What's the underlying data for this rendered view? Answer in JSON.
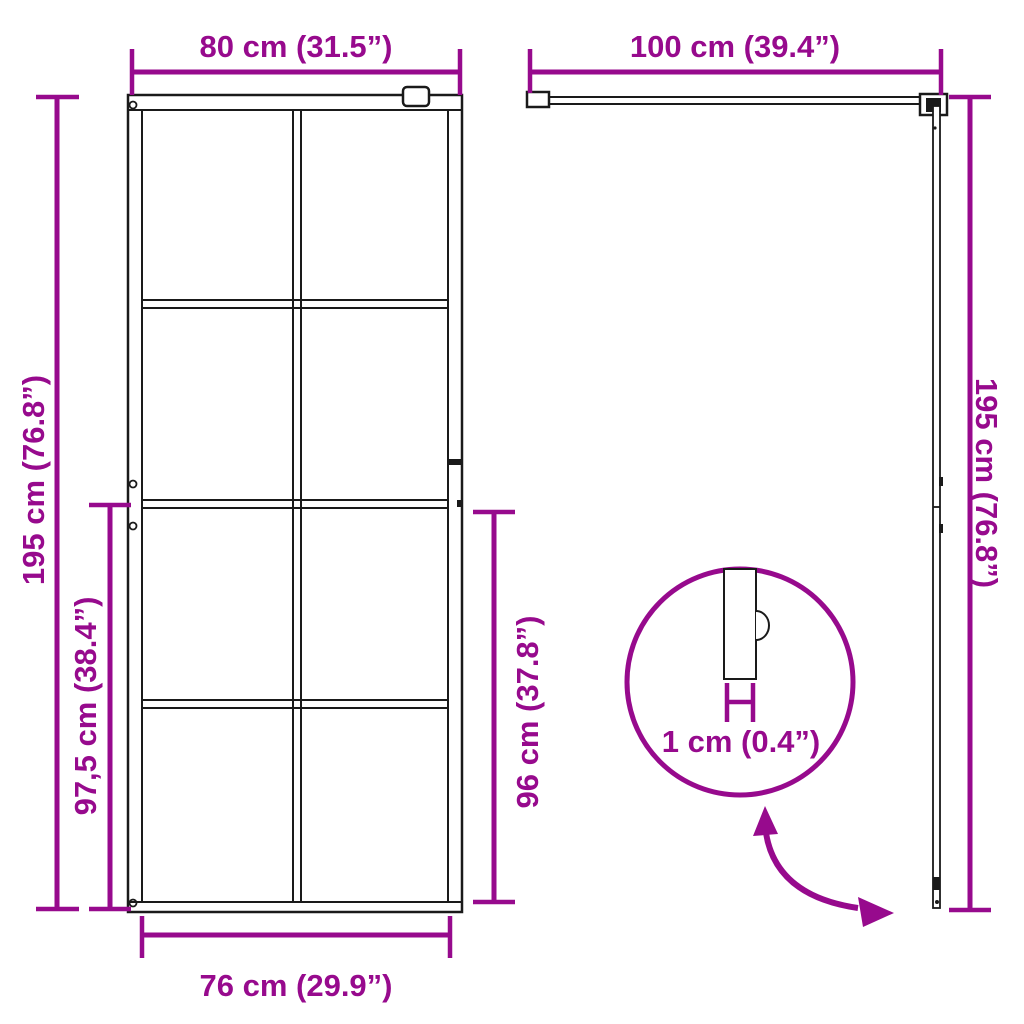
{
  "colors": {
    "accent": "#970A8D",
    "ink": "#1A1A1A",
    "background": "#FFFFFF"
  },
  "front_view": {
    "top_width": "80 cm (31.5”)",
    "left_height": "195 cm (76.8”)",
    "left_partial_height": "97,5 cm (38.4”)",
    "right_partial_height": "96 cm (37.8”)",
    "bottom_width": "76 cm (29.9”)",
    "panel_grid": {
      "columns": 2,
      "rows": 4
    }
  },
  "side_view": {
    "top_width": "100 cm (39.4”)",
    "right_height": "195 cm (76.8”)"
  },
  "detail_callout": {
    "thickness": "1 cm (0.4”)"
  },
  "icons": {
    "swing_arrow": "curved-double-arrow",
    "detail_circle": "magnifier-callout-circle"
  }
}
